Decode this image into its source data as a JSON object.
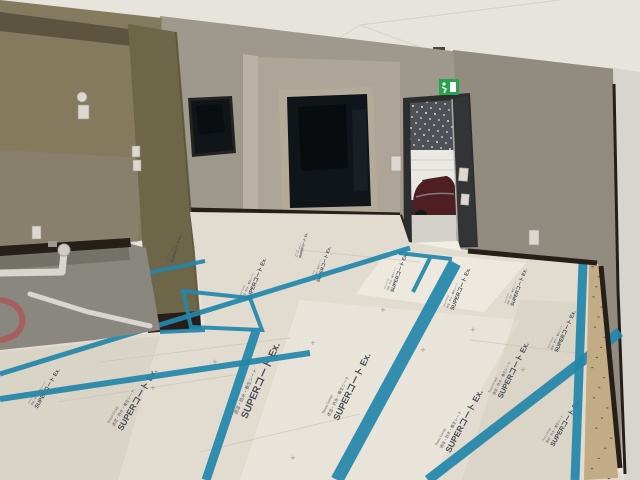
{
  "scene": {
    "alt": "Unfinished interior room with protective floor sheets taped with blue seams, olive partition wall, dark windows, open entry door with a dark-red car visible outside, and an exit pictogram sign above the door."
  },
  "floor_print": {
    "logo": "Tosco Group",
    "subtitle": "透湿・防水・養生シート",
    "title": "SUPERコート Ex.",
    "plus_mark": "+"
  },
  "palette": {
    "ceiling": "#e7e4dd",
    "seam": "#c8c4ba",
    "wallOlive": "#847b5f",
    "oliveDark": "#6e6649",
    "oliveBand": "#554e39",
    "wallGreige": "#9f998d",
    "wallAlcove": "#ada598",
    "wallRight": "#918b80",
    "wallWhite": "#d8d5ce",
    "trimDark": "#261f19",
    "glass": "#10151a",
    "winFrame": "#b3aa9a",
    "doorDark": "#2c2d2f",
    "doorLeaf": "#323436",
    "extDark": "#4e5257",
    "extWhite": "#e9e8e3",
    "carBody": "#4e1e23",
    "pavement": "#d3d1ca",
    "exitGreen": "#27a24e",
    "paper": "#e2dcd0",
    "paperHi": "#f2eee4",
    "paperSh": "#cfc8ba",
    "tape": "#2486aa",
    "pit": "#8a8780",
    "pitSh": "#6e6b63",
    "pipe": "#d9d6cf",
    "hose": "#a85a5a",
    "plywood": "#c2ab85",
    "ink": "#474c55"
  }
}
